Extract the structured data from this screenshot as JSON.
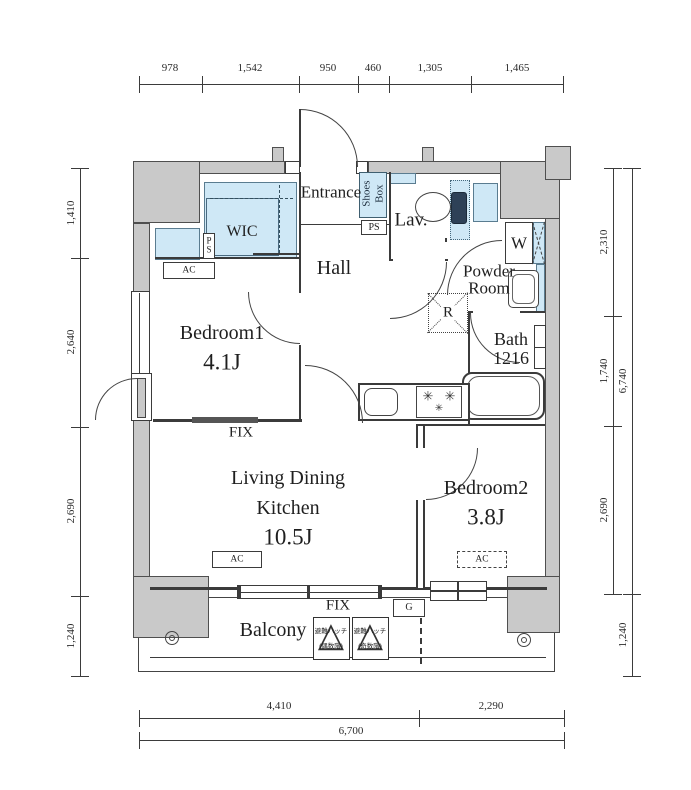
{
  "plan": {
    "rooms": {
      "entrance": "Entrance",
      "hall": "Hall",
      "lav": "Lav.",
      "powder_line1": "Powder",
      "powder_line2": "Room",
      "bath_name": "Bath",
      "bath_size": "1216",
      "wic": "WIC",
      "bedroom1_name": "Bedroom1",
      "bedroom1_size": "4.1J",
      "bedroom2_name": "Bedroom2",
      "bedroom2_size": "3.8J",
      "ldk_line1": "Living Dining",
      "ldk_line2": "Kitchen",
      "ldk_size": "10.5J",
      "balcony": "Balcony"
    },
    "labels": {
      "shoes_line1": "Shoes",
      "shoes_line2": "Box",
      "ps": "PS",
      "ac": "AC",
      "fix": "FIX",
      "w": "W",
      "r": "R",
      "g": "G",
      "hatch_even_line1": "避難ハッチ",
      "hatch_even_line2": "(偶数階)",
      "hatch_odd_line1": "避難ハッチ",
      "hatch_odd_line2": "(奇数階)",
      "triangle": "△",
      "burner": "✳"
    },
    "dims": {
      "top": [
        "978",
        "1,542",
        "950",
        "460",
        "1,305",
        "1,465"
      ],
      "left": [
        "1,410",
        "2,640",
        "2,690",
        "1,240"
      ],
      "right": [
        "2,310",
        "1,740",
        "2,690"
      ],
      "right_total": "6,740",
      "right_balcony": "1,240",
      "bottom": [
        "4,410",
        "2,290"
      ],
      "bottom_total": "6,700"
    },
    "colors": {
      "wall": "#c9c9c9",
      "line": "#3b3b3b",
      "fixture_blue": "#cfe8f6",
      "tank": "#2e4157"
    }
  }
}
